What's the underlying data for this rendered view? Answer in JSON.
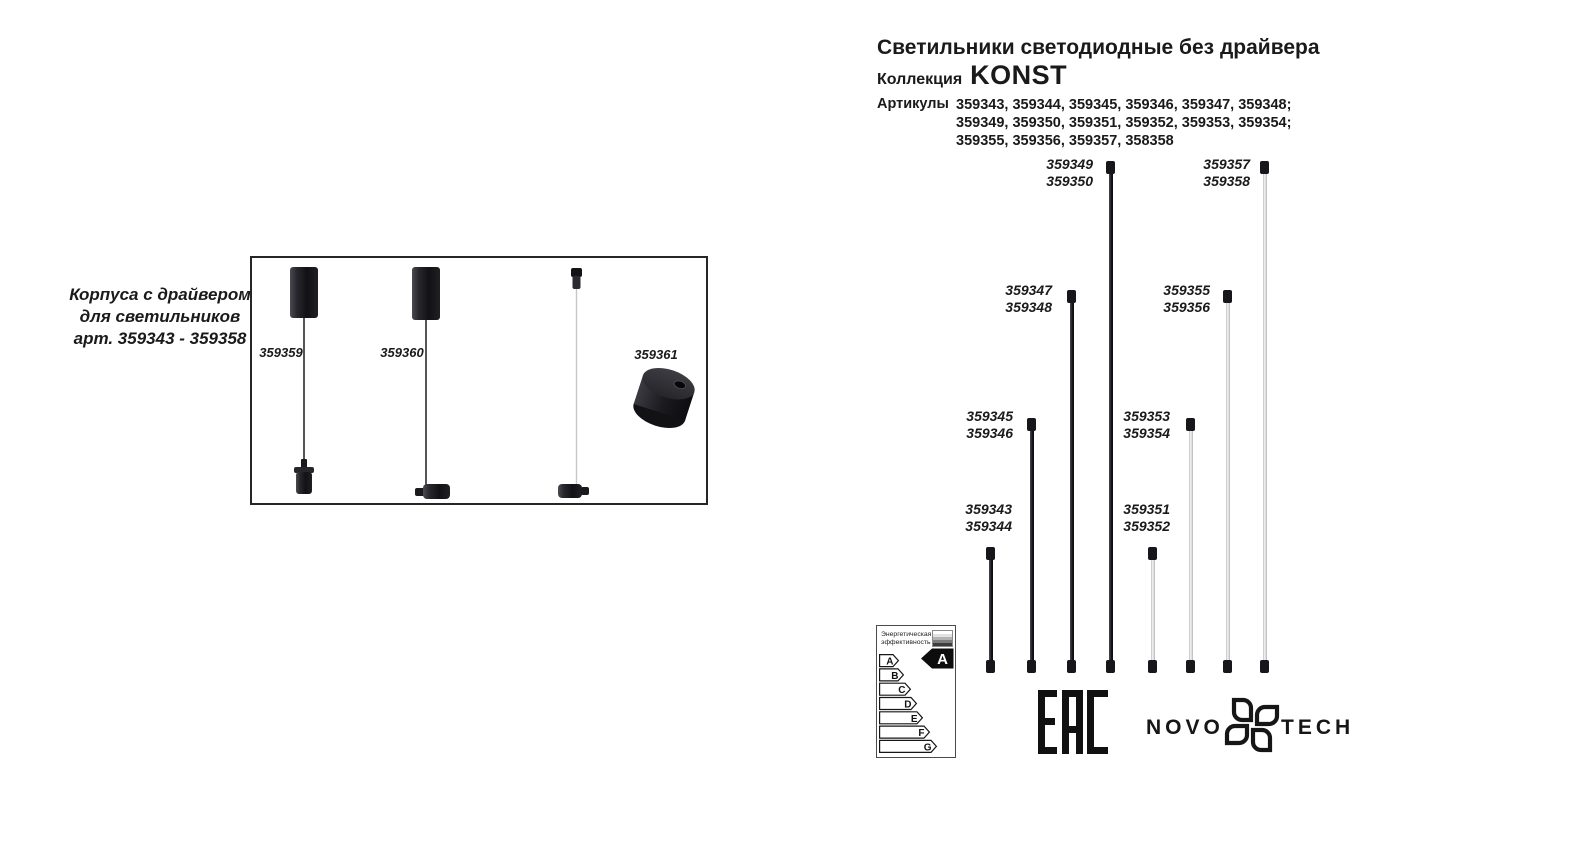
{
  "header": {
    "title": "Светильники светодиодные без драйвера",
    "collection_label": "Коллекция",
    "collection_name": "KONST",
    "articles_label": "Артикулы",
    "articles_lines": [
      "359343, 359344, 359345, 359346, 359347, 359348;",
      "359349, 359350, 359351, 359352, 359353, 359354;",
      "359355, 359356, 359357, 358358"
    ]
  },
  "left_panel": {
    "caption_lines": [
      "Корпуса с драйвером",
      "для светильников",
      "арт. 359343 - 359358"
    ],
    "item_labels": [
      "359359",
      "359360",
      "359361"
    ]
  },
  "diagram": {
    "rods": [
      {
        "labels": [
          "359343",
          "359344"
        ],
        "finish": "black",
        "length_rank": 1
      },
      {
        "labels": [
          "359345",
          "359346"
        ],
        "finish": "black",
        "length_rank": 2
      },
      {
        "labels": [
          "359347",
          "359348"
        ],
        "finish": "black",
        "length_rank": 3
      },
      {
        "labels": [
          "359349",
          "359350"
        ],
        "finish": "black",
        "length_rank": 4
      },
      {
        "labels": [
          "359351",
          "359352"
        ],
        "finish": "white",
        "length_rank": 1
      },
      {
        "labels": [
          "359353",
          "359354"
        ],
        "finish": "white",
        "length_rank": 2
      },
      {
        "labels": [
          "359355",
          "359356"
        ],
        "finish": "white",
        "length_rank": 3
      },
      {
        "labels": [
          "359357",
          "359358"
        ],
        "finish": "white",
        "length_rank": 4
      }
    ]
  },
  "energy_label": {
    "title_lines": [
      "Энергетическая",
      "эффективность"
    ],
    "classes": [
      "A",
      "B",
      "C",
      "D",
      "E",
      "F",
      "G"
    ],
    "rating": "A"
  },
  "certification": {
    "eac_label": "EAC"
  },
  "brand": {
    "name_prefix": "NOVO",
    "name_suffix": "TECH"
  },
  "colors": {
    "ink": "#1a1a1a",
    "rod_black": "#17171b",
    "rod_white": "#e8e8e8",
    "background": "#ffffff"
  }
}
